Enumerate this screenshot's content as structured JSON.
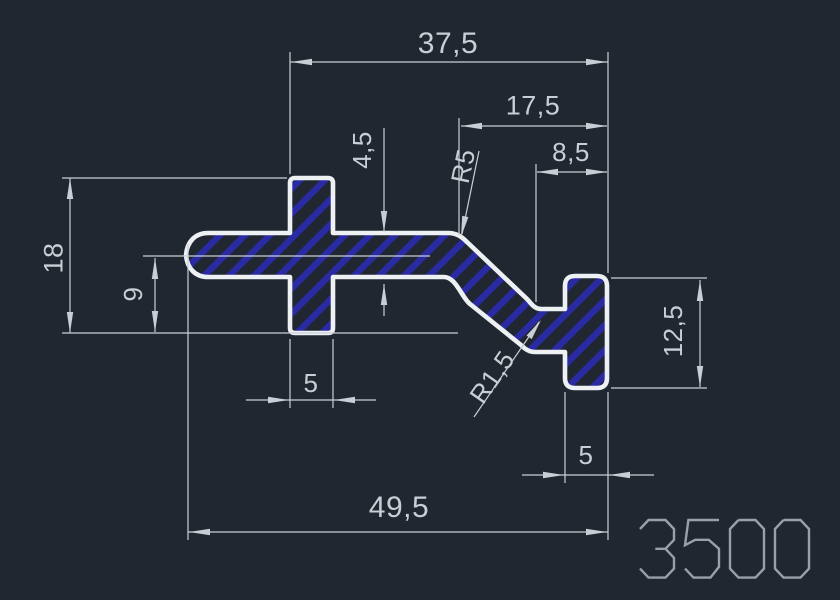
{
  "drawing": {
    "number": "3500",
    "dimensions": {
      "top_width": "37,5",
      "upper_right_width": "17,5",
      "step_width": "8,5",
      "wall_thickness": "4,5",
      "top_radius": "R5",
      "total_height": "18",
      "lower_height": "9",
      "leg_width": "5",
      "inner_radius": "R1,5",
      "right_height": "12,5",
      "right_leg_width": "5",
      "total_width": "49,5"
    },
    "colors": {
      "background": "#212730",
      "profile_outline": "#eef1f4",
      "dimension": "#c9ced6",
      "hatch": "#2c2cae",
      "stamp": "#99a0a8"
    }
  }
}
